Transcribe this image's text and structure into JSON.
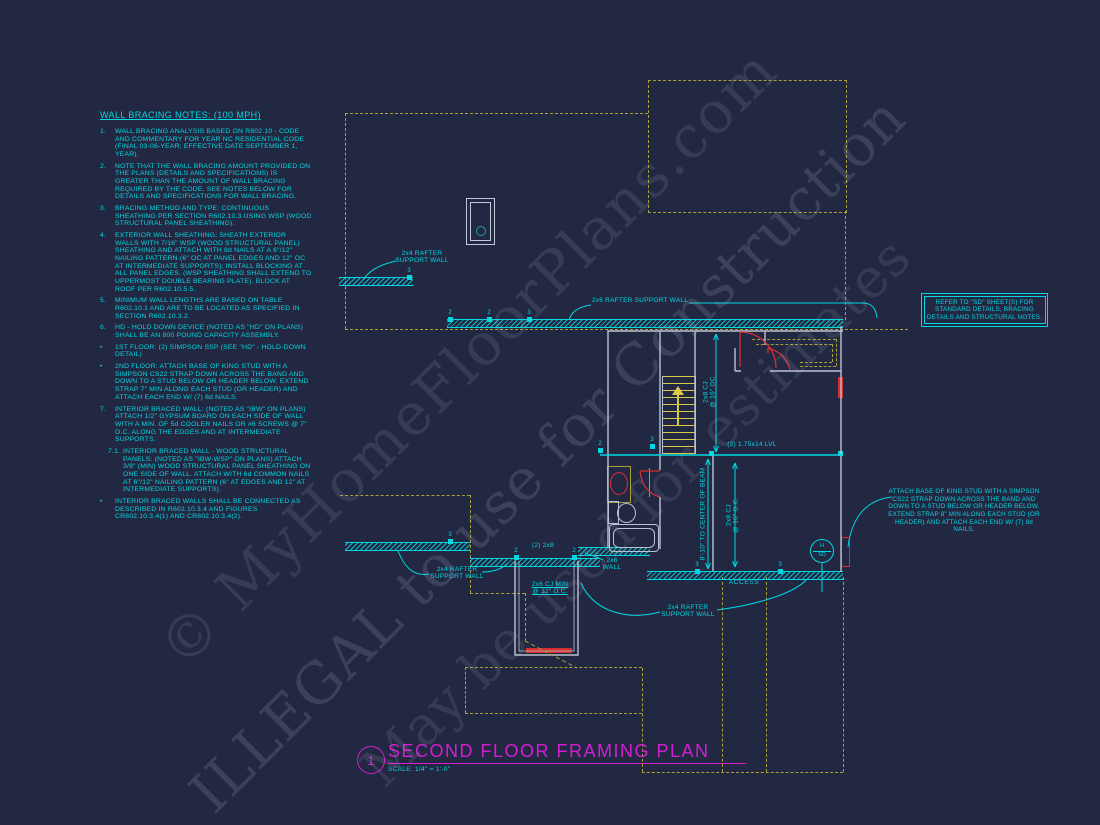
{
  "colors": {
    "background": "#232842",
    "cyan": "#00d8e2",
    "dashed_yellow": "#a8a137",
    "stair_yellow": "#d9c946",
    "magenta": "#d31ed3",
    "red": "#d62f2f",
    "wall_gray": "#b9c2d2"
  },
  "notes": {
    "title": "WALL BRACING NOTES: (100 MPH)",
    "items": [
      {
        "marker": "1.",
        "text": "WALL BRACING ANALYSIS BASED ON R602.10 - CODE AND COMMENTARY FOR YEAR NC RESIDENTIAL CODE (FINAL 03-06-YEAR; EFFECTIVE DATE SEPTEMBER 1, YEAR)."
      },
      {
        "marker": "2.",
        "text": "NOTE THAT THE WALL BRACING AMOUNT PROVIDED ON THE PLANS (DETAILS AND SPECIFICATIONS) IS GREATER THAN THE AMOUNT OF WALL BRACING REQUIRED BY THE CODE. SEE NOTES BELOW FOR DETAILS AND SPECIFICATIONS FOR WALL BRACING."
      },
      {
        "marker": "3.",
        "text": "BRACING METHOD AND TYPE: CONTINUOUS SHEATHING PER SECTION R602.10.3 USING WSP (WOOD STRUCTURAL PANEL SHEATHING)."
      },
      {
        "marker": "4.",
        "text": "EXTERIOR WALL SHEATHING: SHEATH EXTERIOR WALLS WITH 7/16\" WSP (WOOD STRUCTURAL PANEL) SHEATHING AND ATTACH WITH 8d NAILS AT A 6\"/12\" NAILING PATTERN (6\" OC AT PANEL EDGES AND 12\" OC AT INTERMEDIATE SUPPORTS); INSTALL BLOCKING AT ALL PANEL EDGES. (WSP SHEATHING SHALL EXTEND TO UPPERMOST DOUBLE BEARING PLATE). BLOCK AT ROOF PER R602.10.5.5."
      },
      {
        "marker": "5.",
        "text": "MINIMUM WALL LENGTHS ARE BASED ON TABLE R602.10.1 AND ARE TO BE LOCATED AS SPECIFIED IN SECTION R602.10.3.2."
      },
      {
        "marker": "6.",
        "text": "HD - HOLD DOWN DEVICE (NOTED AS \"HD\" ON PLANS) SHALL BE AN 800 POUND CAPACITY ASSEMBLY."
      },
      {
        "marker": "•",
        "text": "1ST FLOOR: (2) SIMPSON SSP (SEE \"HD\" - HOLD-DOWN DETAIL)"
      },
      {
        "marker": "•",
        "text": "2ND FLOOR: ATTACH BASE OF KING STUD WITH A SIMPSON CS22 STRAP DOWN ACROSS THE BAND AND DOWN TO A STUD BELOW OR HEADER BELOW. EXTEND STRAP 7\" MIN ALONG EACH STUD (OR HEADER) AND ATTACH EACH END W/ (7) 8d NAILS."
      },
      {
        "marker": "7.",
        "text": "INTERIOR BRACED WALL: (NOTED AS \"IBW\" ON PLANS) ATTACH 1/2\" GYPSUM BOARD ON EACH SIDE OF WALL WITH A MIN. OF 5d COOLER NAILS OR #6 SCREWS @ 7\" O.C. ALONG THE EDGES AND AT INTERMEDIATE SUPPORTS."
      },
      {
        "marker": "7.1.",
        "text": "INTERIOR BRACED WALL - WOOD STRUCTURAL PANELS: (NOTED AS \"IBW-WSP\" ON PLANS) ATTACH 3/8\" (MIN) WOOD STRUCTURAL PANEL SHEATHING ON ONE SIDE OF WALL. ATTACH WITH 6d COMMON NAILS AT 6\"/12\" NAILING PATTERN (6\" AT EDGES AND 12\" AT INTERMEDIATE SUPPORTS)."
      },
      {
        "marker": "•",
        "text": "INTERIOR BRACED WALLS SHALL BE CONNECTED AS DESCRIBED IN R602.10.3.4 AND FIGURES CR602.10.3.4(1) AND CR602.10.3.4(2)."
      }
    ]
  },
  "plan": {
    "labels": {
      "rafter24": "2x4 RAFTER\nSUPPORT WALL",
      "rafter26": "2x6 RAFTER SUPPORT WALL",
      "lvl": "(2) 1.75x14 LVL",
      "pair2x8": "(2) 2x8",
      "cj16_upper": "2x8 CJ\n@ 16\" OC",
      "cj16_lower": "2x8 CJ\n@ 16\" O.C.",
      "beam_dim": "8'-10\" TO CENTER OF BEAM",
      "cj_min": "2x6 CJ MIN\n@ 32\" O.C.",
      "wall2x6": "2x6\nWALL",
      "access": "ACCESS",
      "hd_top": "H",
      "hd_bottom": "SD"
    },
    "markers": [
      "3",
      "2",
      "2",
      "3",
      "3",
      "2",
      "2",
      "2",
      "3",
      "3",
      "3"
    ]
  },
  "callouts": {
    "sd_box": "REFER TO \"SD\" SHEET(S) FOR STANDARD DETAILS, BRACING DETAILS AND STRUCTURAL NOTES.",
    "king_stud": "ATTACH BASE OF KING STUD WITH A SIMPSON CS22 STRAP DOWN ACROSS THE BAND AND DOWN TO A STUD BELOW OR HEADER BELOW. EXTEND STRAP 8\" MIN ALONG EACH STUD (OR HEADER) AND ATTACH EACH END W/ (7) 8d NAILS."
  },
  "title_block": {
    "number": "1",
    "title": "SECOND FLOOR FRAMING PLAN",
    "scale": "SCALE: 1/4\" = 1'-0\""
  },
  "watermark": {
    "line1": "© MyHomeFloorPlans.com",
    "line2": "ILLEGAL to use for Construction",
    "line3": "May be used for estimates"
  }
}
